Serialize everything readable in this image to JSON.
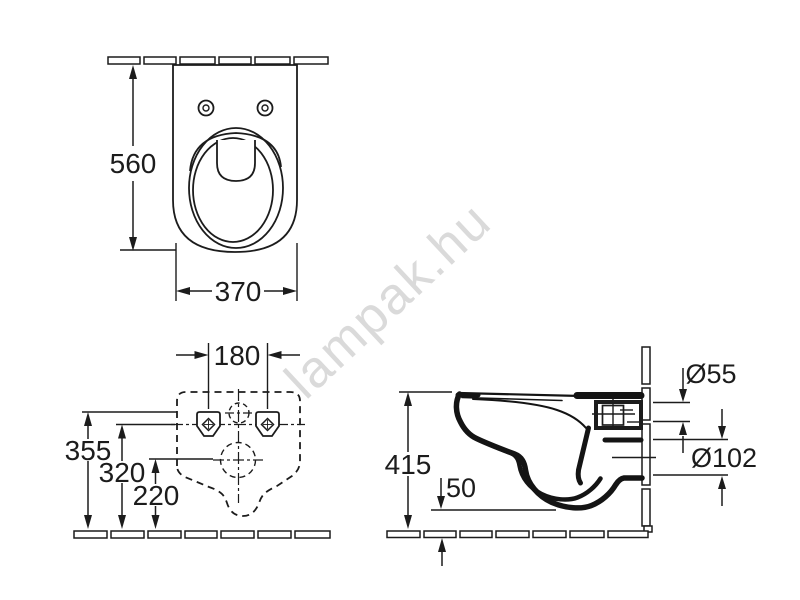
{
  "watermark": {
    "text": "lampak.hu",
    "color": "#dadada"
  },
  "drawing": {
    "line_color": "#1c1c1c",
    "background": "#ffffff"
  },
  "top_view": {
    "dim_height": "560",
    "dim_width": "370"
  },
  "rear_view": {
    "dim_hole_spacing": "180",
    "dim_height_1": "355",
    "dim_height_2": "320",
    "dim_height_3": "220"
  },
  "side_view": {
    "dim_height": "415",
    "dim_clearance": "50",
    "dim_inlet_diameter": "Ø55",
    "dim_outlet_diameter": "Ø102"
  }
}
